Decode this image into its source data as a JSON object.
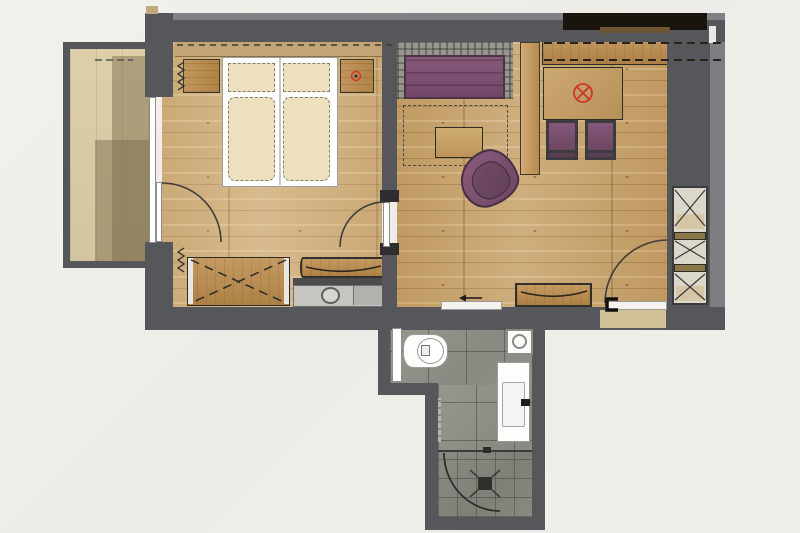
{
  "plan_title": "hotel-suite-floor-plan",
  "colors": {
    "wall": "#56575a",
    "wallLight": "#7d7e81",
    "wallBand": "#808184",
    "wood": "#c6a36d",
    "woodDark": "#9c7a48",
    "balcony": "#d8cba4",
    "balconyShadow": "#a89b78",
    "tile": "#908f89",
    "purple": "#7c5070",
    "purpleDark": "#4e3347",
    "cream": "#ece0bf",
    "furnWood": "#ba8d55",
    "red": "#cf352b",
    "niche": "#1a140e",
    "beige": "#d2c29a",
    "wardrobeBg": "#dcd7cb",
    "glassWhite": "#f4f3ef"
  },
  "rooms": [
    {
      "name": "balcony",
      "floor": "light decking with cast shadow",
      "symbols": [
        "dashed-overhang-line"
      ]
    },
    {
      "name": "bedroom",
      "floor": "oak plank",
      "furniture": [
        "double-bed-two-mattresses",
        "pillow-left",
        "pillow-right",
        "nightstand-left",
        "nightstand-right",
        "headboard-panel",
        "wardrobe-dashed-cross",
        "minibar-unit-with-sink",
        "decor-tray",
        "curtain-symbol-top",
        "curtain-symbol-bottom"
      ],
      "symbols": [
        "red-socket-ring-on-nightstand"
      ],
      "doors": [
        "balcony-glass-door-with-swing-arc",
        "door-to-living-area-with-swing-arc"
      ]
    },
    {
      "name": "living-area",
      "floor": "oak plank",
      "furniture": [
        "purple-sofa-with-plaid-back",
        "coffee-table",
        "purple-swivel-armchair",
        "room-divider-panel",
        "dining-table",
        "purple-stool-1",
        "purple-stool-2",
        "sideboard",
        "dashed-wall-cabinet-lines",
        "black-tv-niche",
        "built-in-wardrobe-three-x-sections",
        "bench-with-tray"
      ],
      "symbols": [
        "red-ceiling-light-circle-x",
        "dashed-rug-outline",
        "entry-direction-arrow"
      ],
      "doors": [
        "entrance-door-with-swing-arc",
        "sliding-door-to-bathroom"
      ]
    },
    {
      "name": "bathroom",
      "floor": "grey tile",
      "fixtures": [
        "toilet",
        "vanity-washbasin-with-faucet",
        "shower-with-floor-drain",
        "curved-glass-shower-door",
        "technical-unit-with-circle",
        "towel-radiator",
        "white-door-panel"
      ]
    },
    {
      "name": "entry-landing",
      "floor": "beige threshold area"
    }
  ]
}
